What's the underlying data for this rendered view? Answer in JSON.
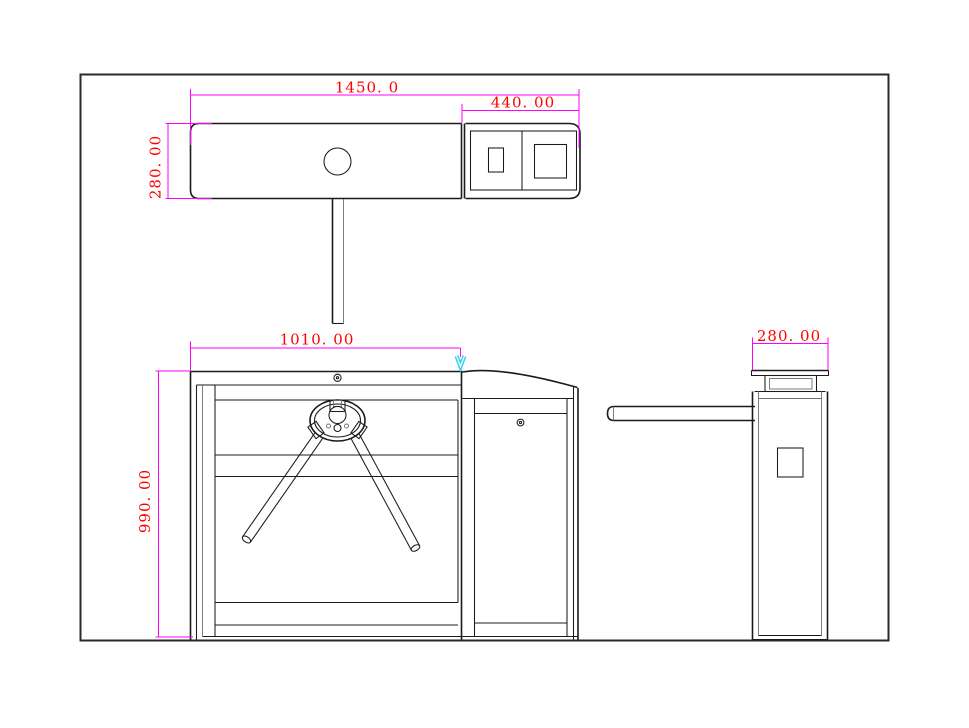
{
  "colors": {
    "line": "#1b1b1b",
    "line_light": "#6f6f6f",
    "dimension_line": "#ff00ff",
    "dimension_text": "#ff0000",
    "arrow_accent": "#2fd5e8",
    "background": "#ffffff"
  },
  "dimensions": {
    "top_total_length": "1450. 0",
    "top_head_length": "440. 00",
    "top_depth": "280. 00",
    "front_width": "1010. 00",
    "front_height": "990. 00",
    "side_depth": "280. 00"
  }
}
